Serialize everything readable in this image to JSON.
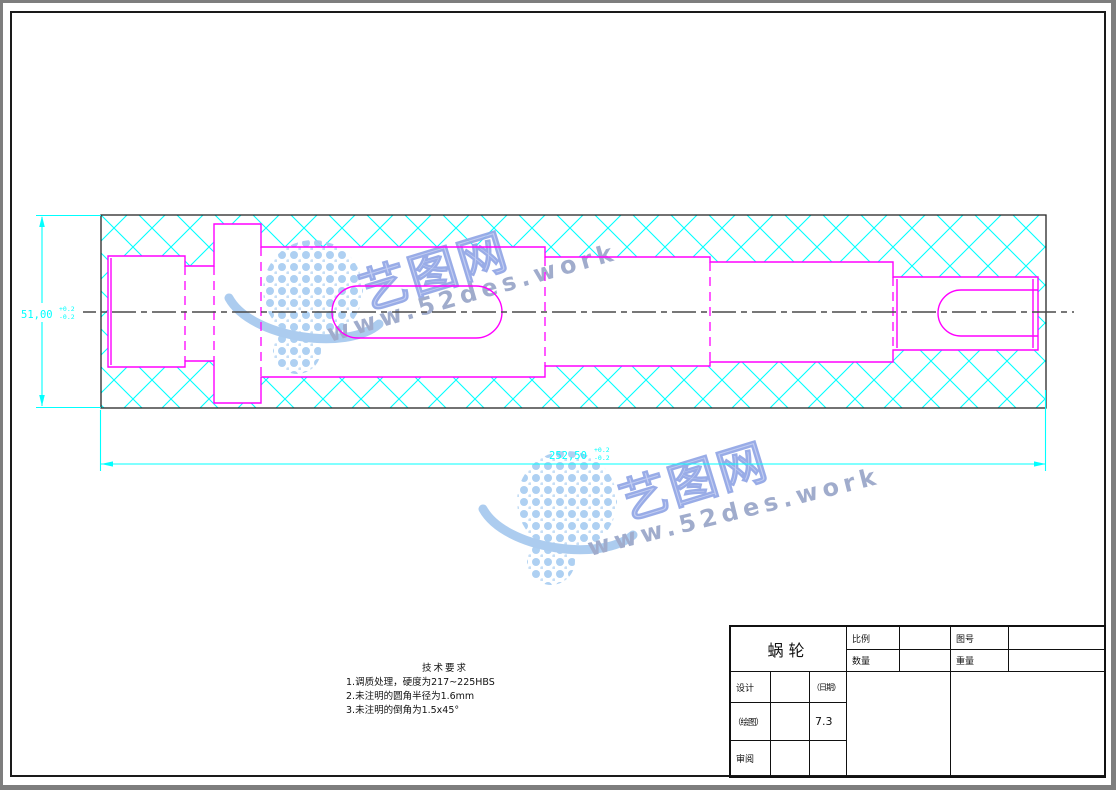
{
  "drawing": {
    "part_name": "蜗轮",
    "dim_width": {
      "value": "51,00",
      "tol_upper": "+0.2",
      "tol_lower": "-0.2"
    },
    "dim_length": {
      "value": "252,50",
      "tol_upper": "+0.2",
      "tol_lower": "-0.2"
    }
  },
  "tech_requirements": {
    "title": "技术要求",
    "items": [
      "1.调质处理，硬度为217~225HBS",
      "2.未注明的圆角半径为1.6mm",
      "3.未注明的倒角为1.5x45°"
    ]
  },
  "title_block": {
    "part_name": "蜗轮",
    "scale_label": "比例",
    "quantity_label": "数量",
    "drawing_no_label": "图号",
    "weight_label": "重量",
    "design_label": "设计",
    "date_label": "（日期）",
    "draft_label": "（绘图）",
    "draft_date": "7.3",
    "review_label": "审阅"
  },
  "watermark": {
    "brand": "艺图网",
    "url": "www.52des.work"
  },
  "colors": {
    "outline_magenta": "#ff00ff",
    "hatch_cyan": "#00ffff",
    "dimension_cyan": "#00ffff",
    "centerline_gray": "#4a4a4a",
    "watermark_blue": "#a9cdf0",
    "frame_black": "#1a1a1a"
  }
}
